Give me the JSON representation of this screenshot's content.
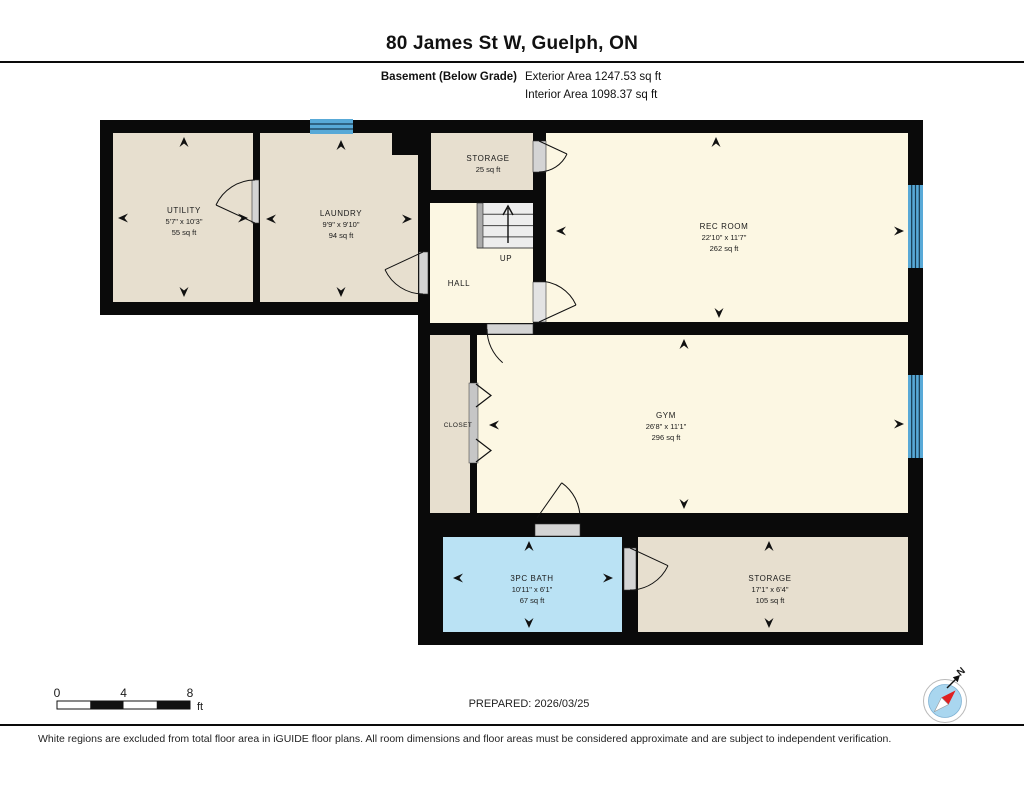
{
  "header": {
    "title": "80 James St W, Guelph, ON",
    "floor_label": "Basement (Below Grade)",
    "exterior_area": "Exterior Area 1247.53 sq ft",
    "interior_area": "Interior Area 1098.37 sq ft"
  },
  "rooms": {
    "utility": {
      "name": "UTILITY",
      "dims": "5'7\" x 10'3\"",
      "area": "55 sq ft"
    },
    "laundry": {
      "name": "LAUNDRY",
      "dims": "9'9\" x 9'10\"",
      "area": "94 sq ft"
    },
    "storage_top": {
      "name": "STORAGE",
      "area": "25 sq ft"
    },
    "rec_room": {
      "name": "REC ROOM",
      "dims": "22'10\" x 11'7\"",
      "area": "262 sq ft"
    },
    "hall": {
      "name": "HALL"
    },
    "stairs": {
      "label": "UP"
    },
    "closet": {
      "name": "CLOSET"
    },
    "gym": {
      "name": "GYM",
      "dims": "26'8\" x 11'1\"",
      "area": "296 sq ft"
    },
    "bath": {
      "name": "3PC BATH",
      "dims": "10'11\" x 6'1\"",
      "area": "67 sq ft"
    },
    "storage_bottom": {
      "name": "STORAGE",
      "dims": "17'1\" x 6'4\"",
      "area": "105 sq ft"
    }
  },
  "scale_bar": {
    "ticks": [
      "0",
      "4",
      "8"
    ],
    "unit": "ft"
  },
  "compass": {
    "north_label": "N"
  },
  "footer": {
    "prepared": "PREPARED: 2026/03/25",
    "disclaimer": "White regions are excluded from total floor area in iGUIDE floor plans. All room dimensions and floor areas must be considered approximate and are subject to independent verification."
  },
  "colors": {
    "wall": "#0a0a0a",
    "room_beige": "#e7dfcf",
    "room_cream": "#fcf7e3",
    "bath_blue": "#bae2f4",
    "window_blue": "#58a9d7"
  }
}
